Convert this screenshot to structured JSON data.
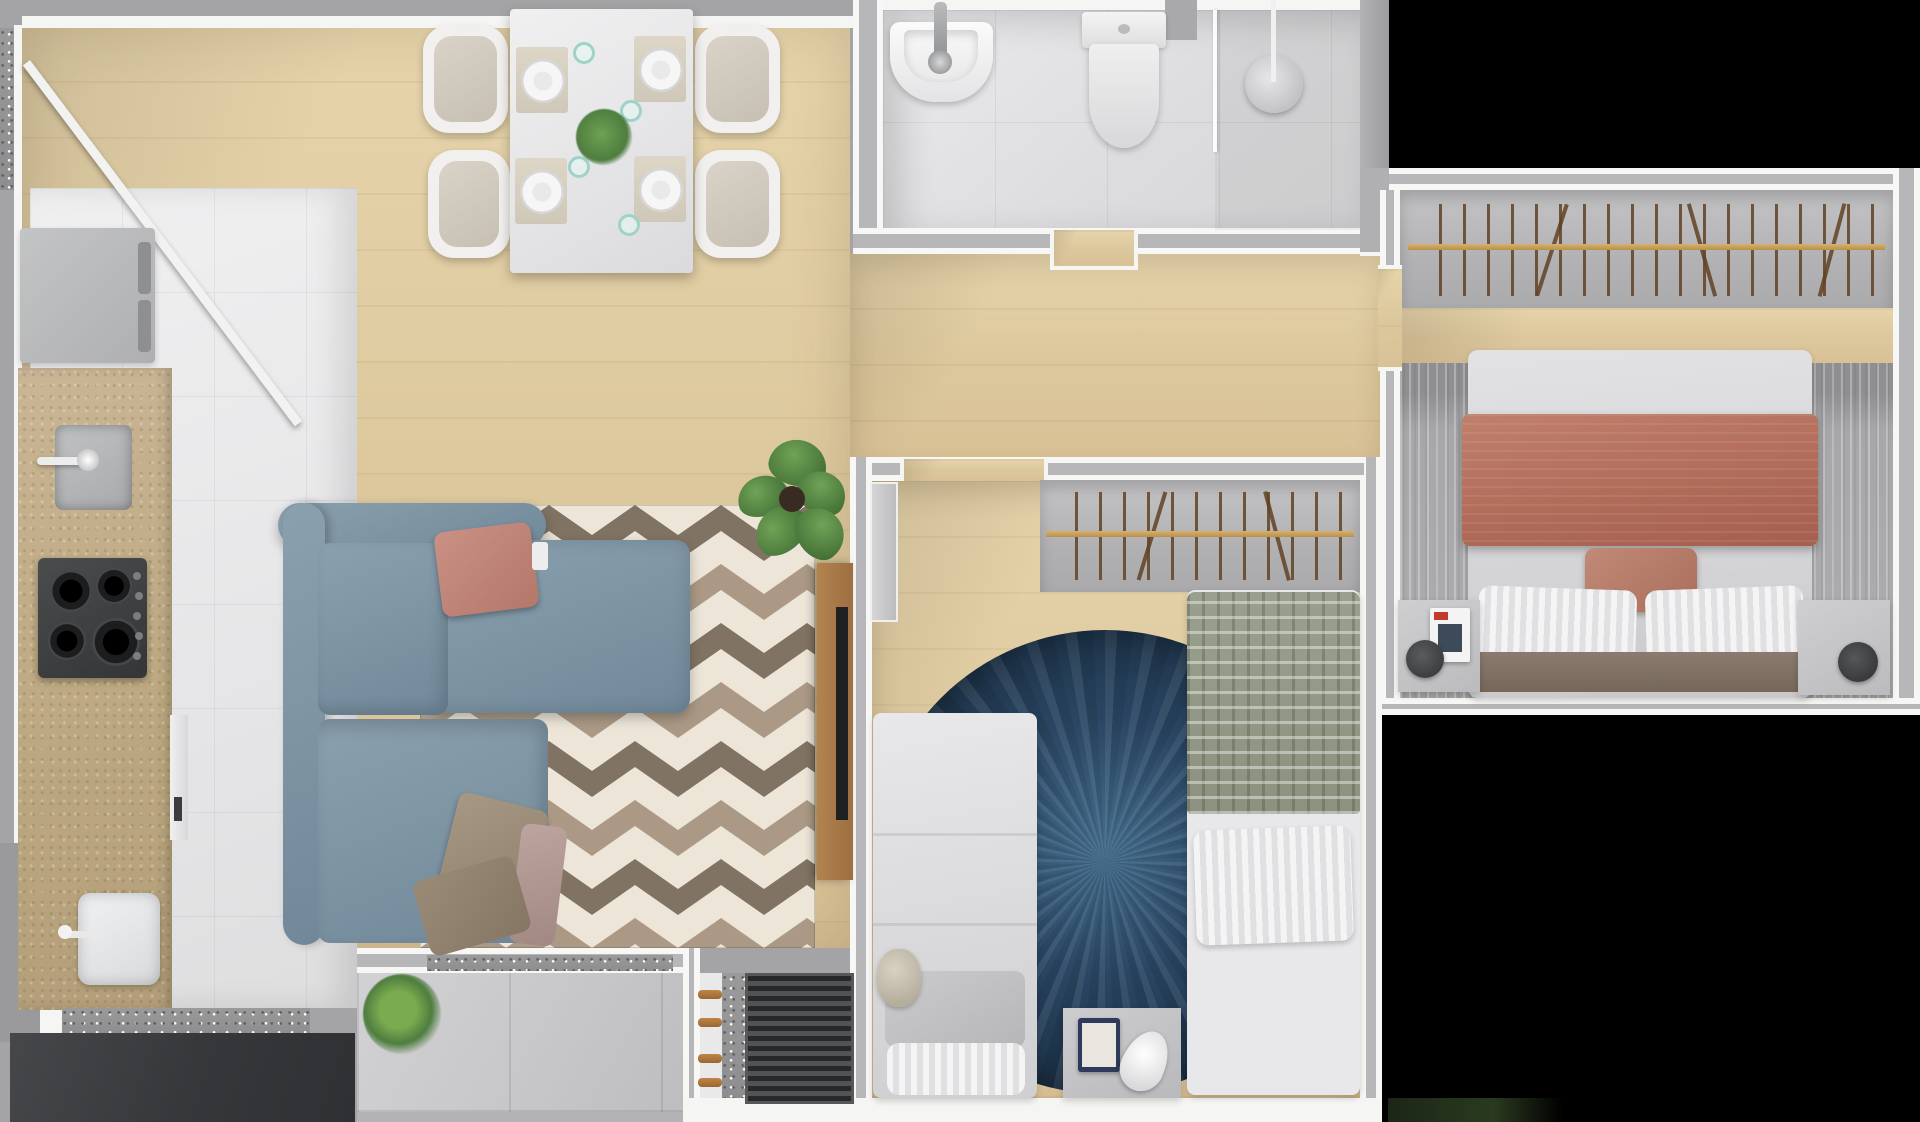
{
  "meta": {
    "scene": "3d-apartment-floor-plan-top-view",
    "canvas_width": 1920,
    "canvas_height": 1122,
    "visible_text": ""
  },
  "palette": {
    "wall-gray": "#a4a4a6",
    "wall-white": "#f5f5f4",
    "outside-black": "#000000",
    "wood-floor": "#ddc89d",
    "kitchen-tile": "#ebebec",
    "bath-tile": "#e2e2e4",
    "balcony-tile": "#c9c9cb",
    "counter-beige": "#c2ad8d",
    "sofa-blue": "#7f96a4",
    "rug-chevron-cream": "#ece5d8",
    "rug-chevron-taupe": "#a4917c",
    "rug-chevron-brown": "#6e5f4f",
    "rug-round-blue": "#2a4663",
    "blanket-terracotta": "#b8705f",
    "pillow-coral": "#c18275",
    "bed-blanket-sage": "#9aa08e",
    "closet-gray": "#b6b6b8",
    "closet-rail-gold": "#c79e58",
    "appliance-dark": "#3e4042",
    "plant-green": "#4e7d3f",
    "wood-panel-brown": "#a97a4e"
  },
  "rooms": [
    {
      "id": "entry-dining-living",
      "label": "open living and dining area"
    },
    {
      "id": "kitchen",
      "label": "kitchen and laundry strip"
    },
    {
      "id": "bathroom",
      "label": "bathroom with shower"
    },
    {
      "id": "hallway",
      "label": "hallway"
    },
    {
      "id": "bedroom-kids",
      "label": "bedroom with two single beds"
    },
    {
      "id": "bedroom-master",
      "label": "master bedroom"
    },
    {
      "id": "balcony",
      "label": "balcony terrace"
    },
    {
      "id": "technical-niche",
      "label": "technical niche"
    },
    {
      "id": "outside",
      "label": "out of bounds"
    }
  ],
  "furniture_counts": {
    "dining_chairs": 4,
    "place_settings": 4,
    "stove_burners": 4,
    "stove_knobs": 5,
    "single_beds": 2,
    "niche_pegs": 4,
    "closets": 2
  }
}
